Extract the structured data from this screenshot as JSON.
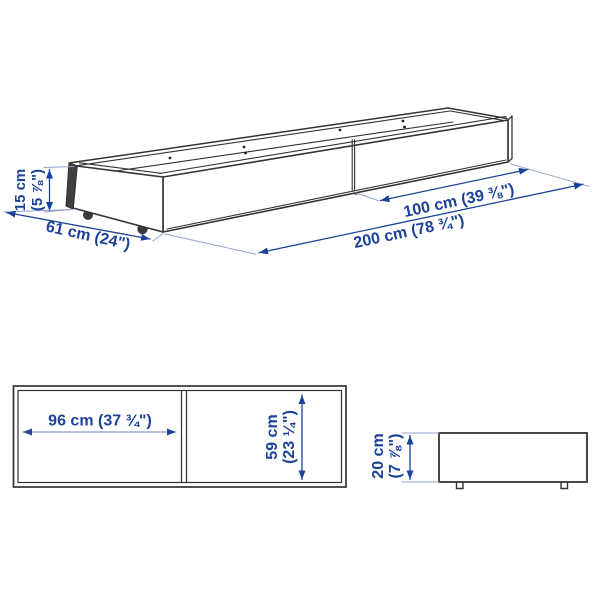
{
  "title": "Under-bed storage box dimension diagram",
  "colors": {
    "dimension_blue": "#1b4299",
    "extension_line_blue": "#93a3cc",
    "drawing_line": "#333333",
    "background": "#ffffff"
  },
  "perspective_view": {
    "height": {
      "line1": "15 cm",
      "line2": "(5 ⅞\")"
    },
    "depth": "61 cm (24\")",
    "half_length": "100 cm (39 ⅜\")",
    "length": "200 cm (78 ¾\")"
  },
  "top_view": {
    "inner_width": "96 cm (37 ¾\")",
    "inner_depth": {
      "line1": "59 cm",
      "line2": "(23 ¼\")"
    }
  },
  "end_view": {
    "height": {
      "line1": "20 cm",
      "line2": "(7 ⅞\")"
    }
  }
}
